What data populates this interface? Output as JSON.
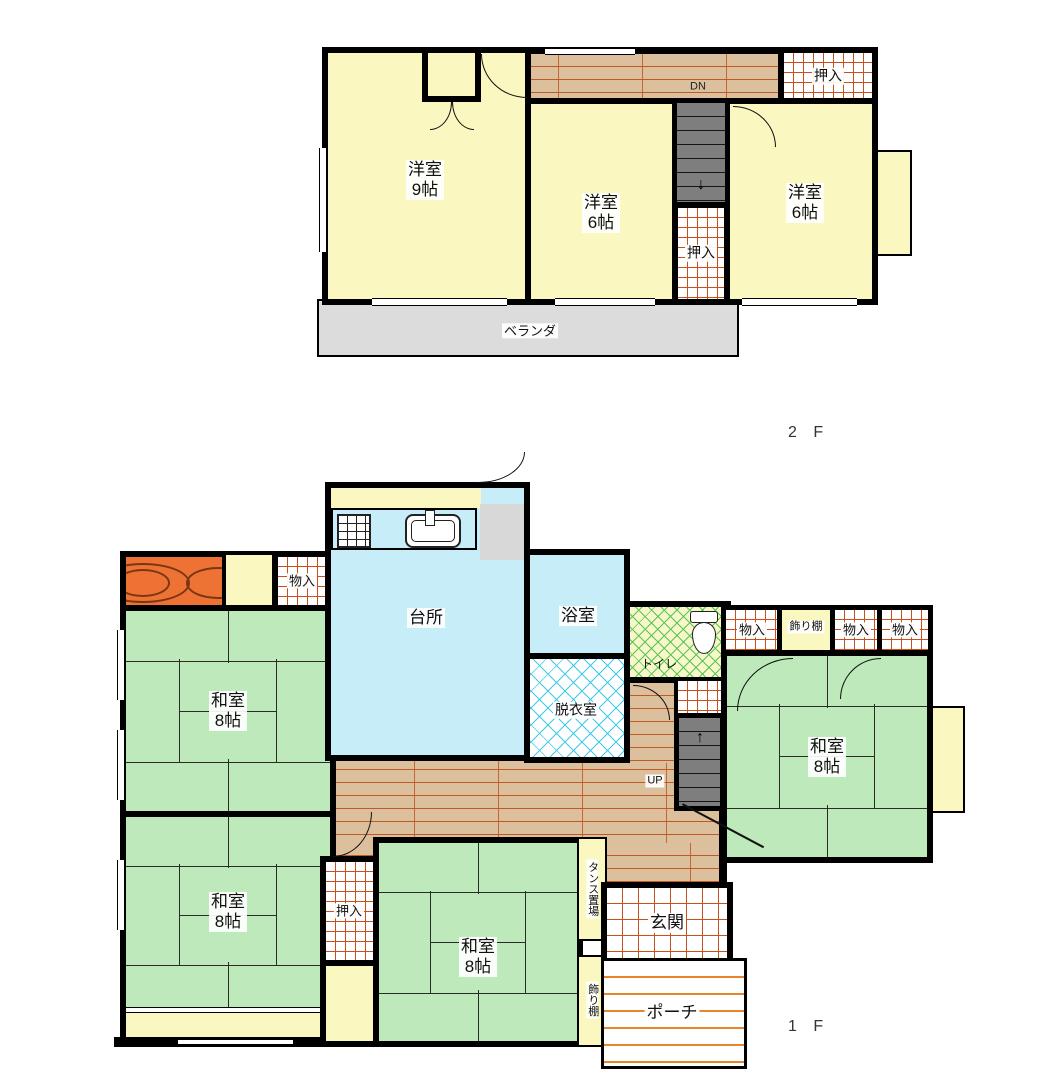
{
  "floor2": {
    "floor_label": "2 F",
    "rooms": {
      "western9": {
        "name": "洋室",
        "size": "9帖"
      },
      "western6_center": {
        "name": "洋室",
        "size": "6帖"
      },
      "western6_right": {
        "name": "洋室",
        "size": "6帖"
      }
    },
    "closet_top_right": "押入",
    "closet_mid": "押入",
    "stairs_down_label": "DN",
    "veranda_label": "ベランダ"
  },
  "floor1": {
    "floor_label": "1 F",
    "rooms": {
      "kitchen": "台所",
      "bath": "浴室",
      "dressing_room": "脱衣室",
      "toilet": "トイレ",
      "washitsu8": {
        "name": "和室",
        "size": "8帖"
      }
    },
    "labels": {
      "oshiire": "押入",
      "monoire": "物入",
      "kazaridana": "飾り棚",
      "tansu_okiba": "タンス置場",
      "genkan": "玄関",
      "porch": "ポーチ",
      "stairs_up_label": "UP"
    }
  },
  "icons": {
    "stairs_down_arrow": "↓",
    "stairs_up_arrow": "↑"
  },
  "colors": {
    "room_yellow": "#fbf7c0",
    "tatami_green": "#bde9bb",
    "water_blue": "#c6edf8",
    "corridor_wood": "#dcbf9c",
    "corridor_line": "#c05a24",
    "stairs_gray": "#7e7e7e",
    "veranda_gray": "#dcdcdc",
    "closet_grid_orange": "#c8501e",
    "porch_line_orange": "#e8852c",
    "toilet_hatch_green": "#56c84e",
    "dressing_hatch_cyan": "#3ecbe8",
    "tokonoma_orange": "#ee7233",
    "wall_black": "#000000"
  }
}
